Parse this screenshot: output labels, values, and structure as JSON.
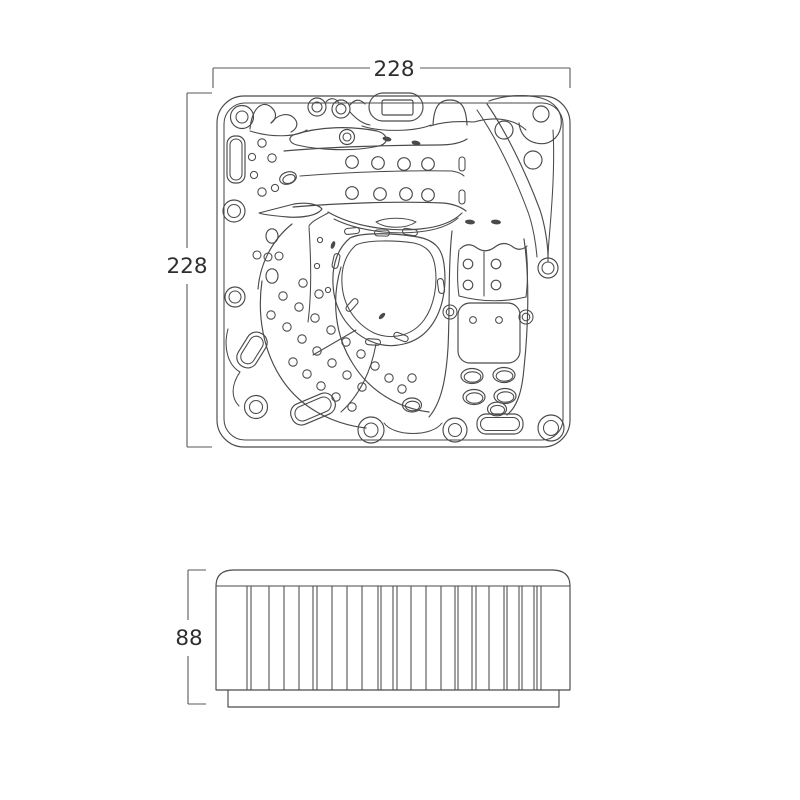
{
  "colors": {
    "background": "#ffffff",
    "line": "#4a4a4a",
    "dimension_text": "#2e2e2e"
  },
  "top_view": {
    "width_label": "228",
    "depth_label": "228"
  },
  "side_view": {
    "height_label": "88"
  }
}
